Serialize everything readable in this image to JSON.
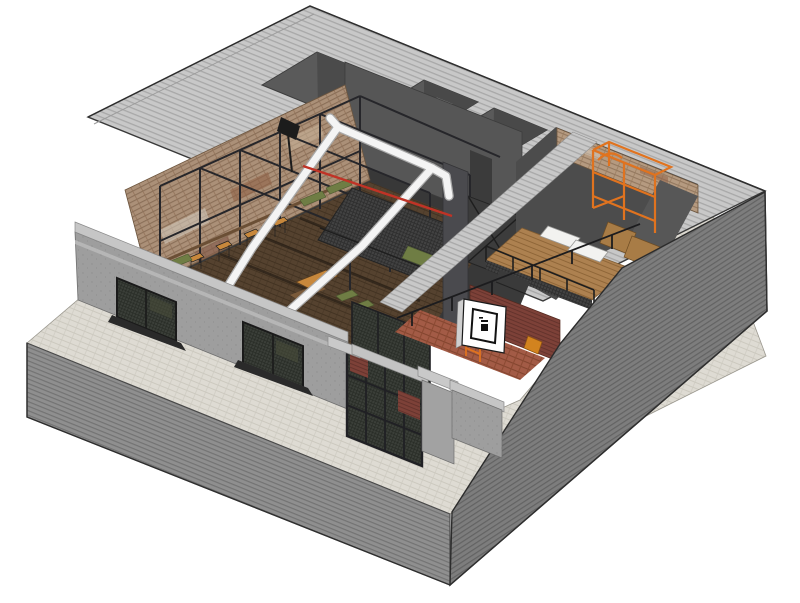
{
  "scene": {
    "title": "Isometric cutaway rendering of a single-storey brick and concrete industrial building on a striped plinth",
    "type": "3d-architectural-model",
    "view": "axonometric-cutaway",
    "background": "#ffffff"
  },
  "palette": {
    "background": "#ffffff",
    "roof_hatch": "#c8c8c8",
    "roof_hatch_line": "#a8a8a8",
    "east_wall": "#7d7d7d",
    "east_wall_line": "#636363",
    "plinth": "#8f8f8f",
    "plinth_line": "#737373",
    "walkway": "#dedbd3",
    "walkway_line": "#ccc9bf",
    "facade_gray": "#9e9e9e",
    "parapet_cap": "#c6c6c6",
    "cornice": "#b8b8b8",
    "interior_wall_dark": "#525252",
    "interior_wall_darker": "#454545",
    "brick_tan": "#ab9078",
    "brick_tan_line": "#8a6f58",
    "brick_red": "#7d4138",
    "tile_terracotta": "#a35b46",
    "steel_black": "#26262a",
    "mesh_dark": "#424242",
    "duct_white": "#f4f4f4",
    "duct_edge": "#a9a9a9",
    "pipe_red": "#c03326",
    "scaffold_orange": "#e0731f",
    "wood_floor": "#55422f",
    "wood_mezzanine": "#ad8150",
    "furniture_tan": "#c8883c",
    "cushion_green": "#6f7d44",
    "board_white": "#f2f2f0",
    "sign_panel": "#ffffff",
    "sign_border": "#111111"
  },
  "regions": {
    "base": {
      "walkway": "pale paved walkway around building",
      "plinth": "striped concrete plinth slab"
    },
    "roof": {
      "deck": "hatched flat roof deck",
      "wells": [
        "open stair well",
        "light well with white door",
        "light well"
      ],
      "door": "white door in light well"
    },
    "main_hall": {
      "floor": "dark timber plank floor",
      "brick_wall": "exposed variegated brick party wall",
      "steel_frame": "black steel portal frame grid",
      "ducts": "white round HVAC duct runs with elbows",
      "pipe": "red sprinkler pipe",
      "mezzanine": "steel mesh mezzanine deck with braced panel",
      "seating": "green cushioned benches",
      "furniture": "wooden tables, benches and tan bar stools",
      "projector": "black projector box on steel frame"
    },
    "right_studio": {
      "brick_wall": "exposed brick end wall",
      "scaffold": "orange steel scaffold frame",
      "mezzanine_floor": "timber mezzanine deck",
      "drafting_boards": "two white tilted drafting boards",
      "desks": "timber work desks",
      "stair": "dark steel stair",
      "lower_wall": "red brick lower wall",
      "court": "terracotta tiled entrance court",
      "ladder": "orange ladder frame",
      "railing": "black steel guard railing"
    },
    "facade": {
      "street_wall": "grey rendered street facade",
      "parapet_cap": "light parapet coping",
      "cornice": "projecting cornice band",
      "windows": [
        "steel mesh window left",
        "steel mesh window right"
      ],
      "entrance": {
        "storefront": "black steel framed mesh storefront",
        "piers": "rendered entrance piers with copings",
        "brick_panels": "red brick infill panels"
      },
      "right_wall": "grey facade return beside entrance"
    },
    "east_wall": "tall hatched flank wall",
    "signboard": {
      "panel": "white square signboard",
      "mark": "black square logo mark"
    }
  }
}
